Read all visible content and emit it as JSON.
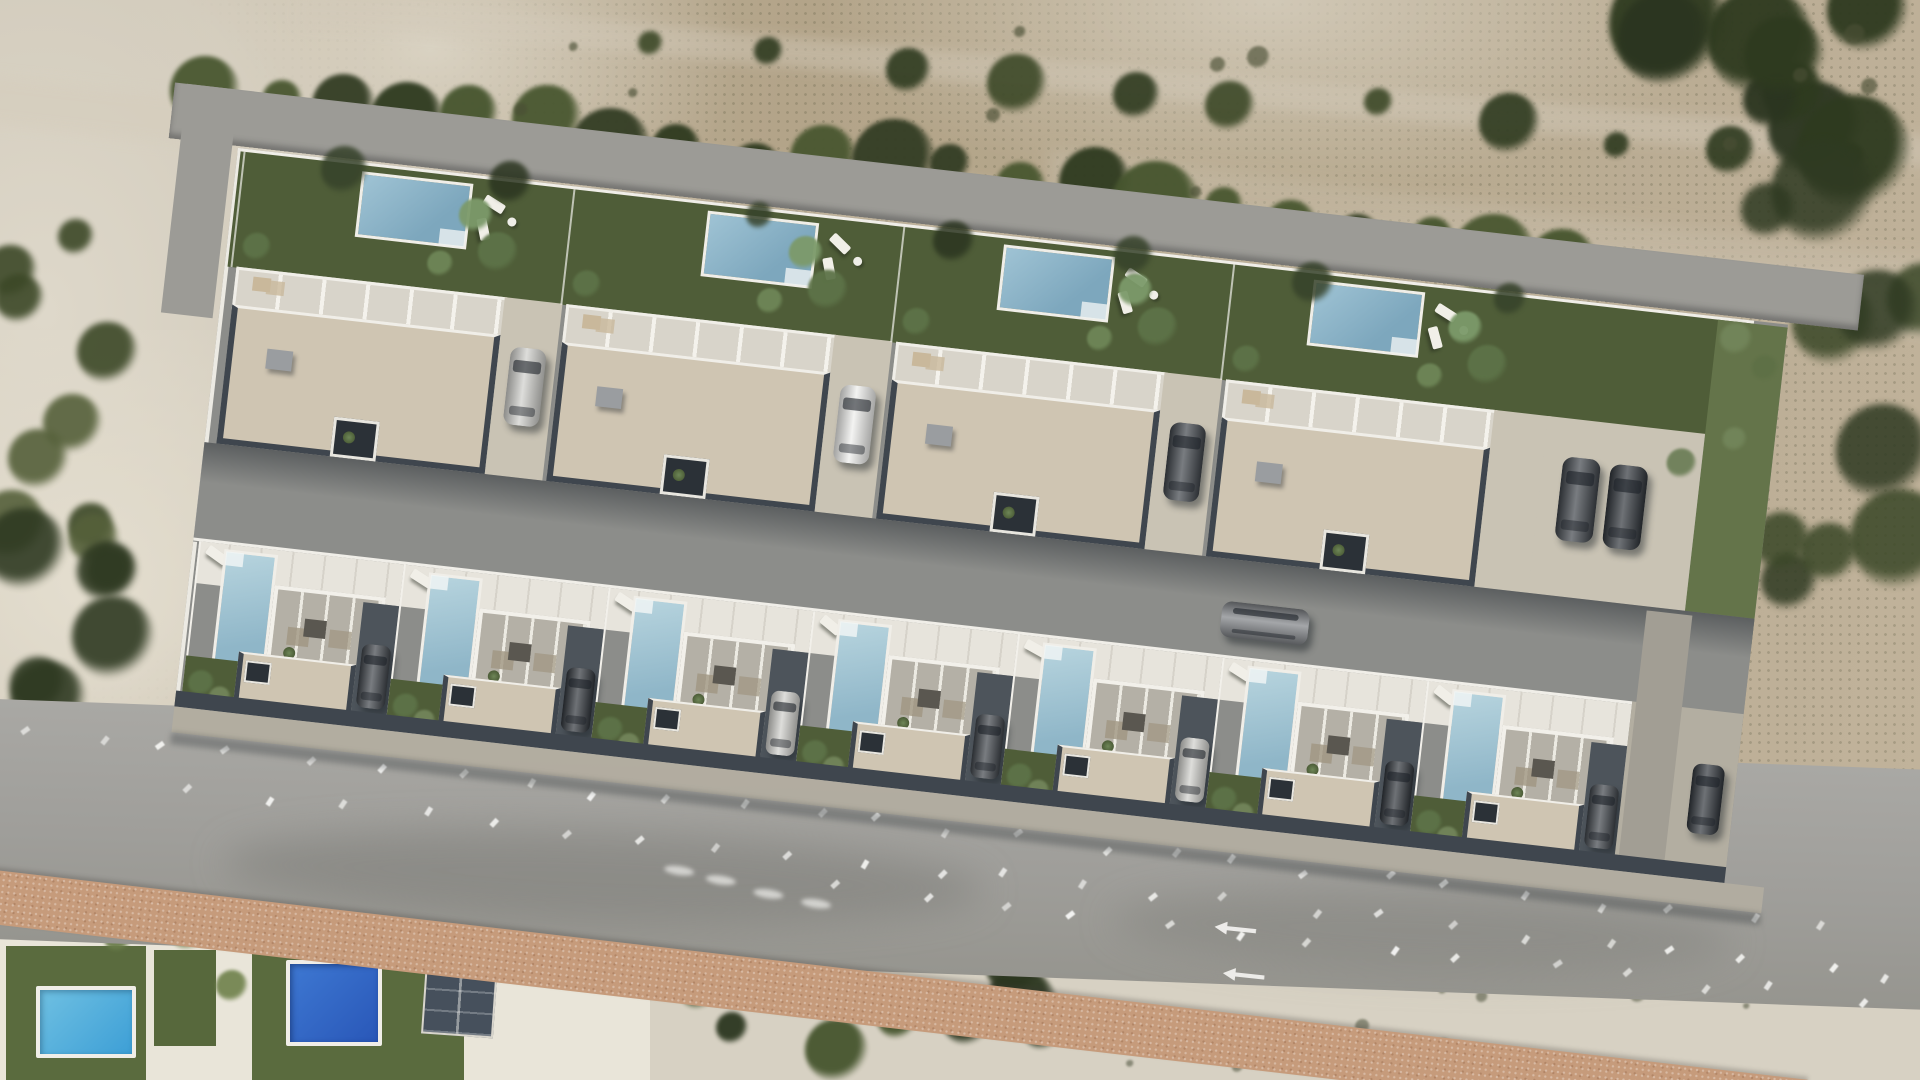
{
  "scene": {
    "kind": "aerial-architectural-render",
    "description": "Drone aerial photo of sandy scrubland with a photorealistic 3D render of a new-build villa development composited in the centre; existing houses with pools at bottom-left, public road with faded markings along the bottom, dirt tracks and shrub rows at the top.",
    "development": {
      "plot_rotation_deg": 6.5,
      "top_row": {
        "villa_count": 4,
        "villa_features": [
          "rear garden",
          "private pool",
          "sun loungers",
          "palms",
          "roof terrace with white pergola",
          "beige gravel flat roof",
          "side driveway with parked car"
        ]
      },
      "bottom_row": {
        "villa_count": 7,
        "villa_features": [
          "front terrace",
          "plunge pool",
          "glazed pergola with patio furniture",
          "beige gravel flat roof",
          "dark side driveway with parked car",
          "small lawn with palms"
        ]
      },
      "internal_road": {
        "surface": "asphalt",
        "cars_on_road": 1
      },
      "guest_parking_cars": 2,
      "right_edge_parked_car": 1,
      "driveway_cars_top_row": 3,
      "driveway_cars_bottom_row": 7
    },
    "neighborhood": {
      "existing_pools": 2,
      "solar_panel_array": 1,
      "white_roof_building": 1,
      "white_van": 1
    },
    "environment": {
      "top": "tan scrubland with dirt tracks and a diagonal row of dark green shrubs",
      "left": "pale sandy ground with olive scrub",
      "bottom": "grey public road with rows of faded white markings, two white arrows, pink gravel footpath, white sandy scrub with bushes"
    }
  },
  "colors": {
    "terrain_tan": "#b3a489",
    "sand_light": "#ded8ca",
    "sand_bottom": "#d7d1c3",
    "scrub_dark": "#2e3a1f",
    "scrub_mid": "#46552e",
    "scrub_olive": "#55603a",
    "access_road": "#9c9b96",
    "asphalt": "#8c8d8a",
    "asphalt_shadow": "#565b5e",
    "public_road": "#a5a4a0",
    "gravel_pink": "#c69b7b",
    "wall_charcoal": "#3f464e",
    "wall_dark": "#2b3137",
    "roof_beige": "#cfc5b2",
    "paved_light": "#c9c3b4",
    "white_trim": "#f0eee8",
    "terrace_white": "#e7e4dc",
    "garden_green": "#4f5d38",
    "lawn_green": "#64744a",
    "pool_steel_a": "#9fc3d4",
    "pool_steel_b": "#7da7bd",
    "pool_pale_a": "#b7d4de",
    "pool_pale_b": "#8fb6c8",
    "pool_cyan_a": "#6fc0e2",
    "pool_cyan_b": "#3d9fd6",
    "pool_deep_a": "#3e78d2",
    "pool_deep_b": "#2957b8",
    "car_silver": "#cfcfcb",
    "car_dark": "#3f444a",
    "car_darker": "#30353b",
    "car_gray": "#7d8084",
    "car_white": "#eeeeec",
    "solar_panel": "#46505c",
    "marking_white": "#faf9f6"
  }
}
